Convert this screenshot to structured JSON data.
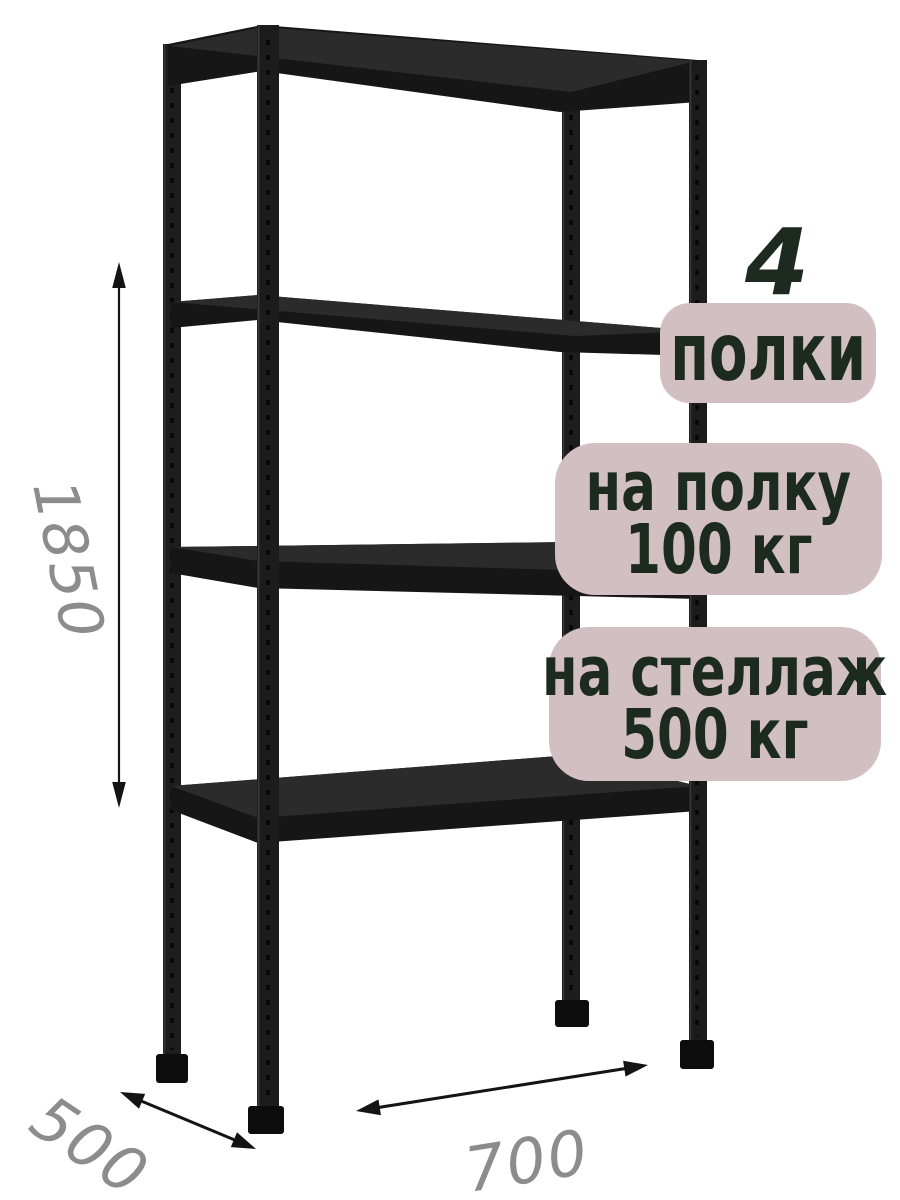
{
  "product": {
    "type_hint": "metal shelving rack illustration",
    "badges": {
      "count": {
        "number": "4",
        "label": "полки"
      },
      "per_shelf": {
        "line1": "на полку",
        "line2": "100 кг"
      },
      "per_rack": {
        "line1": "на стеллаж",
        "line2": "500 кг"
      }
    },
    "dimensions": {
      "height": "1850",
      "depth": "500",
      "width": "700"
    }
  },
  "colors": {
    "background": "#ffffff",
    "badge_bg": "#d2bfc1",
    "badge_text": "#1c2a20",
    "dimension_text": "#8c8c8c",
    "arrow": "#141414",
    "metal_dark": "#161616",
    "metal_top_face": "#2b2b2b",
    "foot": "#0c0c0c"
  }
}
